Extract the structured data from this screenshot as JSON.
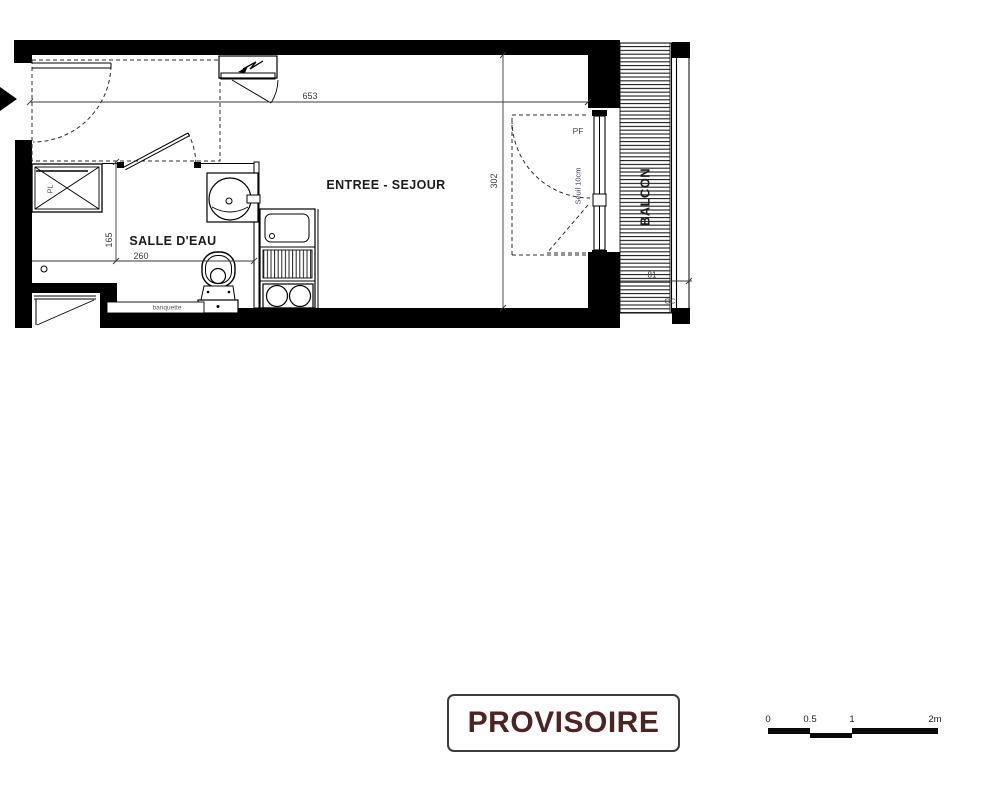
{
  "plan": {
    "rooms": {
      "entree_sejour": "ENTREE - SEJOUR",
      "salle_deau": "SALLE D'EAU",
      "balcon": "BALCON"
    },
    "labels": {
      "pl": "PL",
      "pf": "PF",
      "seuil": "Seuil 10cm",
      "gc": "GC",
      "banquette": "banquette"
    },
    "dims": {
      "total_width": "653",
      "total_depth": "302",
      "sdb_depth": "165",
      "sdb_width": "260",
      "balcony_width": "81"
    }
  },
  "stamp": {
    "text": "PROVISOIRE",
    "text_color": "#4d2323",
    "border_color": "#3c3c3c"
  },
  "scale": {
    "labels": [
      "0",
      "0.5",
      "1",
      "2m"
    ],
    "bar_color": "#0a0a0a"
  },
  "colors": {
    "wall": "#000000",
    "line": "#222222",
    "dim_text": "#3a3a3a",
    "small_label": "#39445a"
  }
}
